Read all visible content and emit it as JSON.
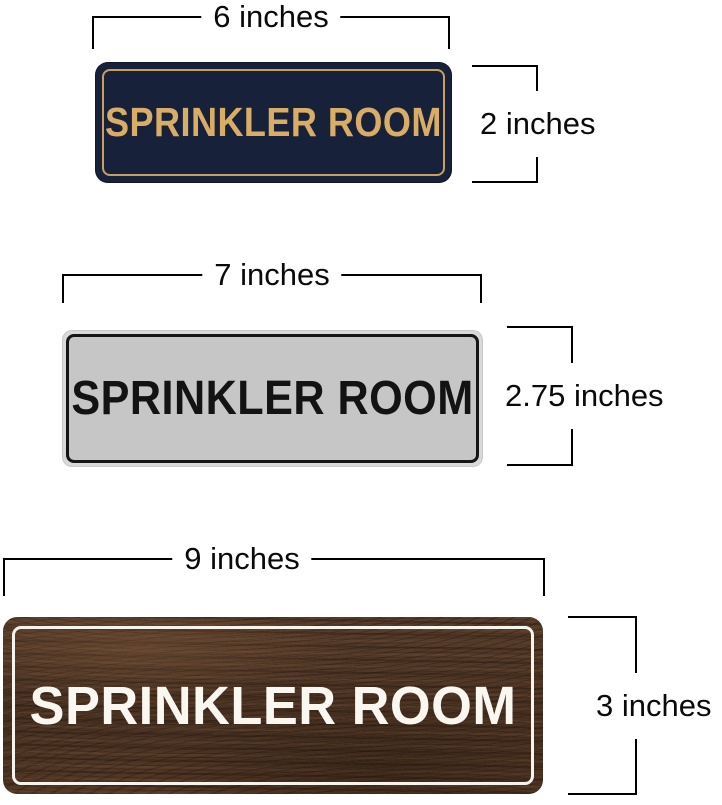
{
  "signs": [
    {
      "label": "SPRINKLER ROOM",
      "width_label": "6 inches",
      "height_label": "2 inches",
      "colors": {
        "face": "#18213a",
        "border": "#c7a05f",
        "text": "#d9ad66"
      }
    },
    {
      "label": "SPRINKLER ROOM",
      "width_label": "7 inches",
      "height_label": "2.75 inches",
      "colors": {
        "face": "#c6c6c6",
        "rim": "#d9d9d9",
        "border": "#151515",
        "text": "#131313"
      }
    },
    {
      "label": "SPRINKLER ROOM",
      "width_label": "9 inches",
      "height_label": "3 inches",
      "colors": {
        "face": "#4c3424",
        "border": "#f6f3ec",
        "text": "#faf7f1"
      }
    }
  ],
  "annotation": {
    "line_color": "#000000",
    "background": "#ffffff"
  }
}
